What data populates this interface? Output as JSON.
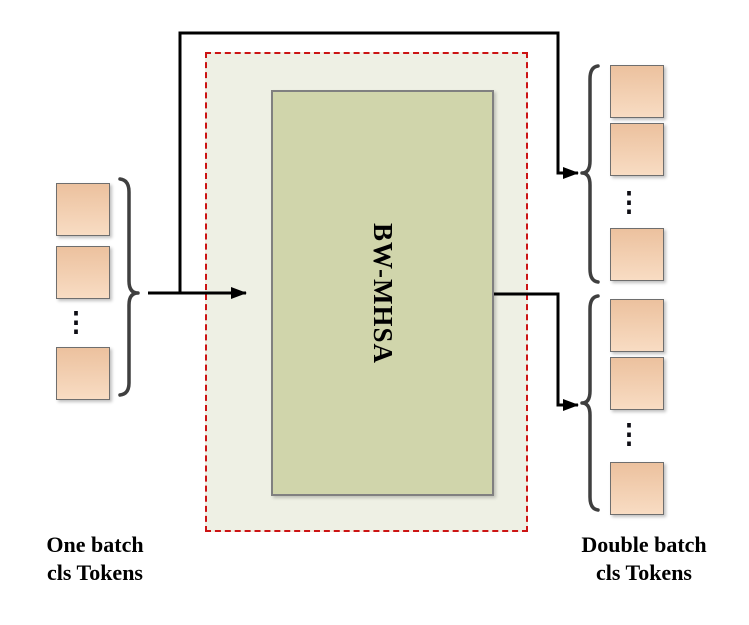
{
  "module": {
    "label": "BW-MHSA"
  },
  "left_group": {
    "label_line1": "One batch",
    "label_line2": "cls Tokens",
    "ellipsis": "⋮",
    "square_count": 3
  },
  "right_top_group": {
    "ellipsis": "⋮",
    "square_count": 3
  },
  "right_bottom_group": {
    "ellipsis": "⋮",
    "square_count": 3
  },
  "right_label": {
    "line1": "Double batch",
    "line2": "cls Tokens"
  },
  "colors": {
    "token-fill-top": "#ecc19e",
    "token-fill-bottom": "#f8dcc3",
    "token-border": "#6e6e6e",
    "module-fill": "#d0d5ab",
    "module-border": "#808080",
    "inner-bg": "#eef0e4",
    "dashed-border": "#cc1414",
    "line-color": "#000000",
    "brace-color": "#3f3f3f",
    "text-color": "#000000"
  }
}
